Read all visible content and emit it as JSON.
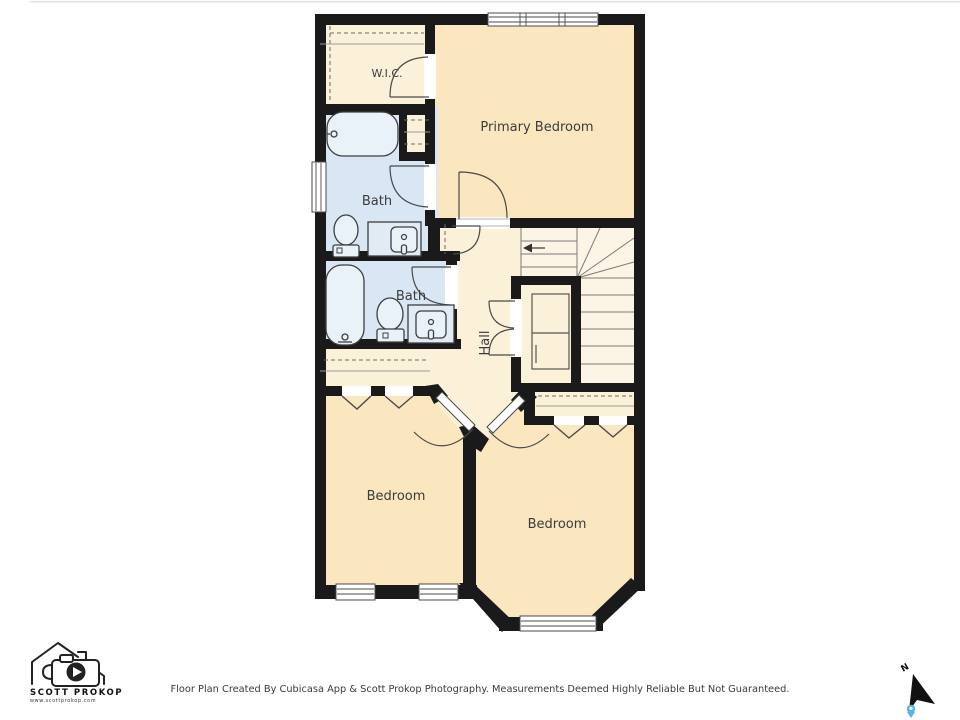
{
  "floorplan": {
    "rooms": [
      {
        "label": "W.I.C."
      },
      {
        "label": "Primary Bedroom"
      },
      {
        "label": "Bath"
      },
      {
        "label": "Bath"
      },
      {
        "label": "Hall"
      },
      {
        "label": "Bedroom"
      },
      {
        "label": "Bedroom"
      }
    ],
    "colors": {
      "wall": "#1a1a1a",
      "bedroom": "#fae7bf",
      "closet": "#fbf1d9",
      "stairs": "#fcf4e4",
      "bath": "#d9e7f4"
    }
  },
  "footer": {
    "disclaimer": "Floor Plan Created By Cubicasa App & Scott Prokop Photography. Measurements Deemed Highly Reliable But Not Guaranteed.",
    "logo": {
      "name": "SCOTT PROKOP",
      "website": "www.scottprokop.com"
    },
    "compass": {
      "north_label": "N"
    }
  }
}
